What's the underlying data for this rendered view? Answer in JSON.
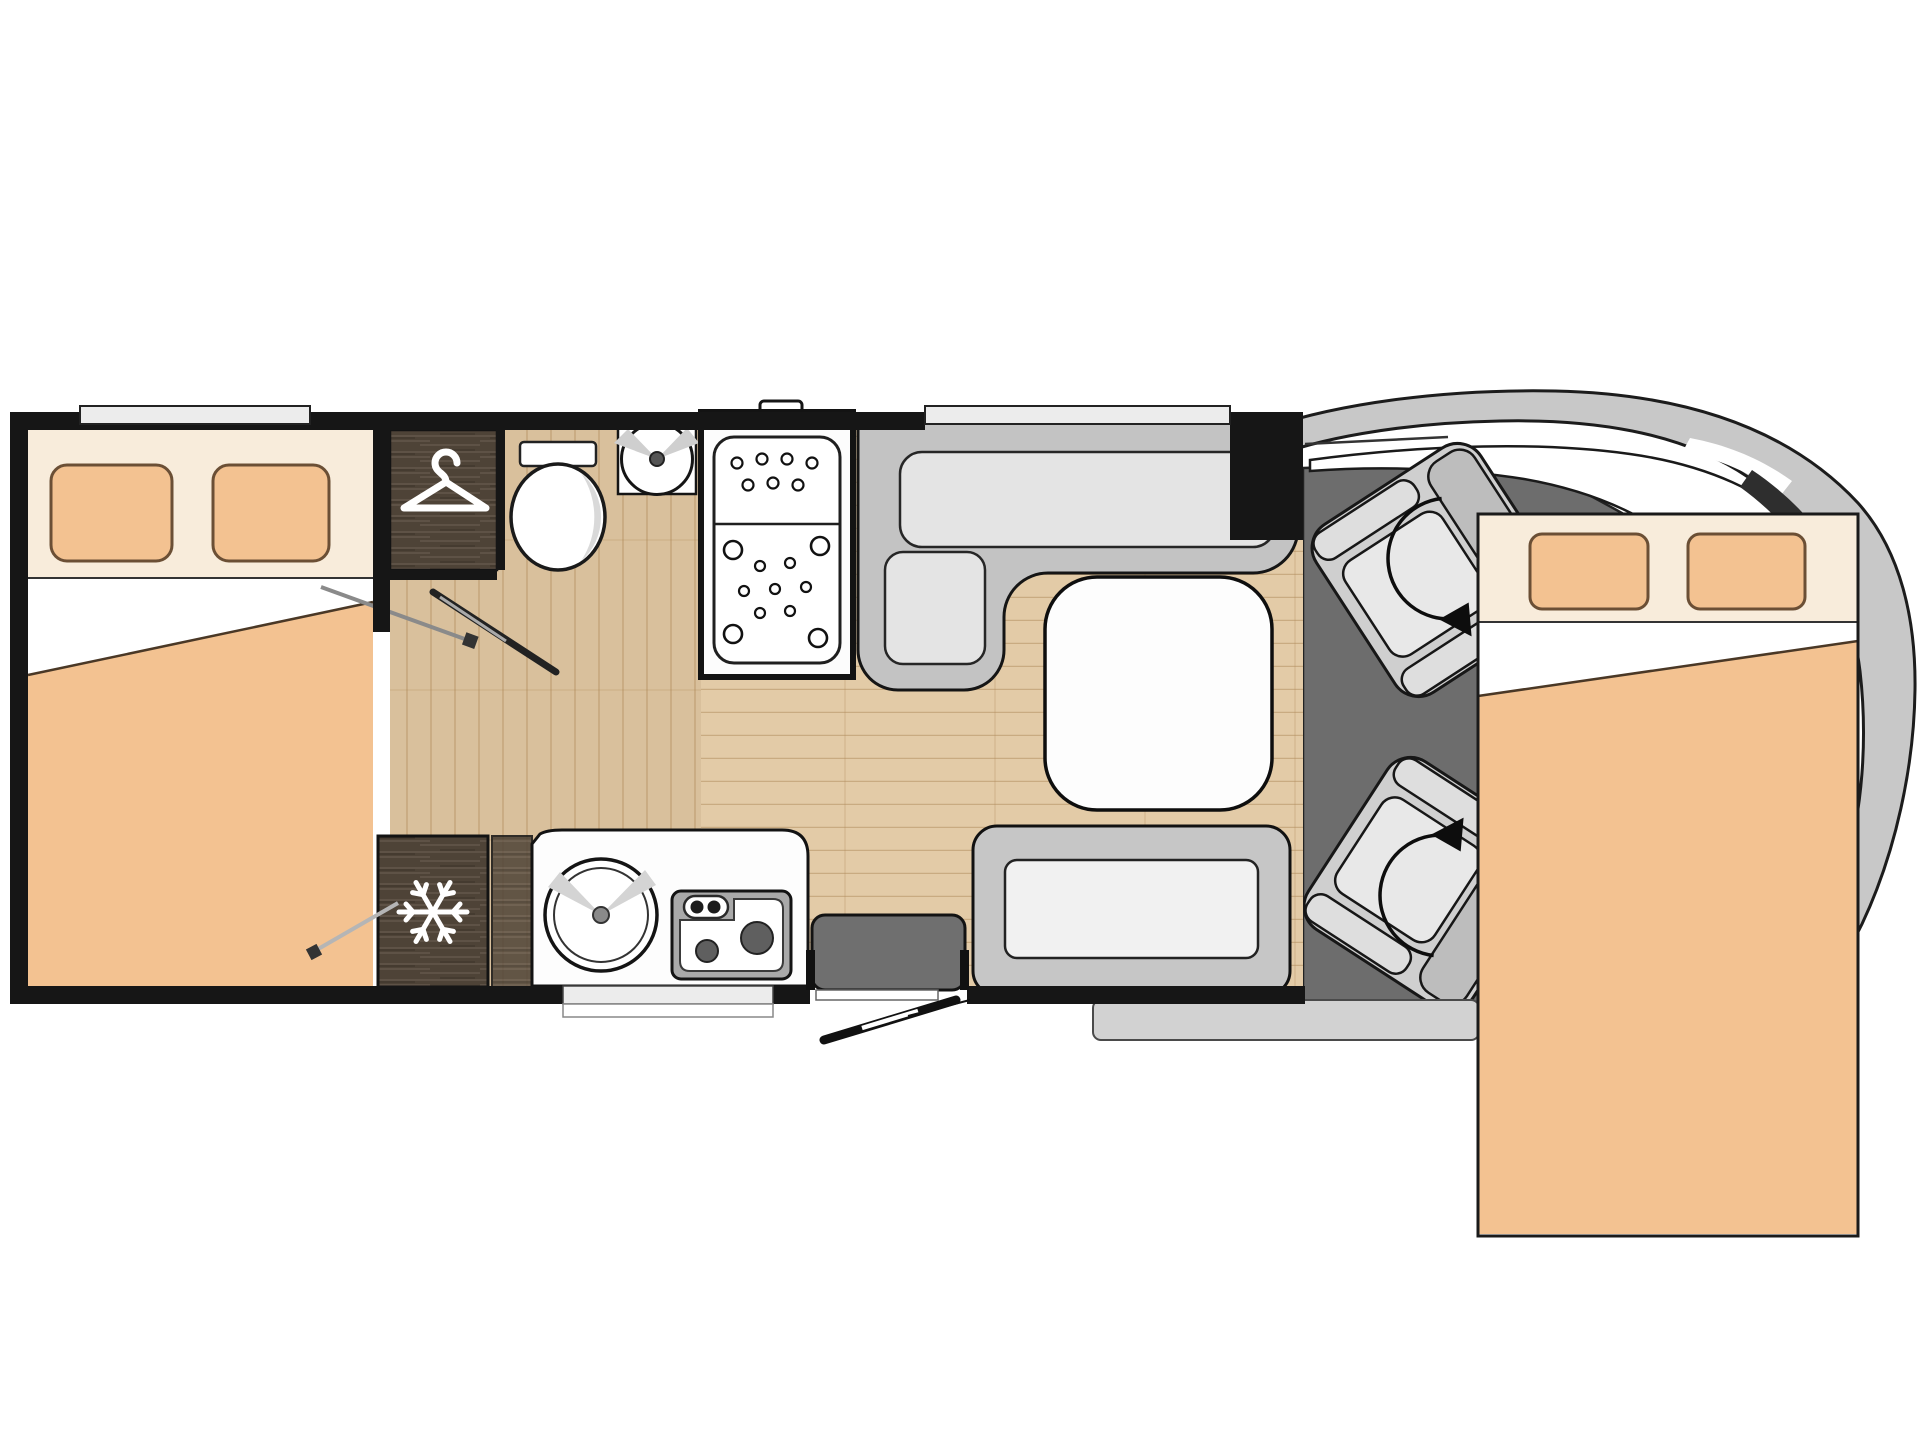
{
  "title": "motorhome-floorplan",
  "colors": {
    "outline": "#151515",
    "wall": "#161616",
    "window_light": "#ececec",
    "floor_main": "#e3cba7",
    "floor_hall": "#d9c09c",
    "wood": "#4e4337",
    "wood_grain": "#63564a",
    "bedding": "#f3c291",
    "bedding_light": "#f8ecdb",
    "pillow_outline": "#6b4f35",
    "sheet_white": "#ffffff",
    "seat_gray": "#c3c3c3",
    "seat_light": "#e4e4e4",
    "backrest_gray": "#b5b5b5",
    "bench_gray": "#c6c6c6",
    "bench_light": "#f1f1f1",
    "table": "#fdfdfd",
    "step": "#6f6f6f",
    "cab_floor": "#6d6d6d",
    "body": "#c8c8c8",
    "burner": "#5f5f5f",
    "skirt": "#d2d2d2"
  },
  "icons": [
    "hanger-icon",
    "snowflake-icon",
    "rotation-arrow-icon",
    "door-swing-icon",
    "shower-drain-holes-icon"
  ],
  "features": [
    "rear-double-bed-with-two-pillows",
    "wardrobe",
    "toilet",
    "washbasin",
    "shower-cubicle",
    "fridge-freezer",
    "kitchen-round-sink",
    "two-burner-hob",
    "l-shaped-dinette",
    "dinette-table",
    "travel-bench-seat",
    "entry-door-with-swing",
    "driver-swivel-seat",
    "passenger-swivel-seat",
    "drop-down-front-double-bed",
    "vehicle-cab-outline"
  ]
}
